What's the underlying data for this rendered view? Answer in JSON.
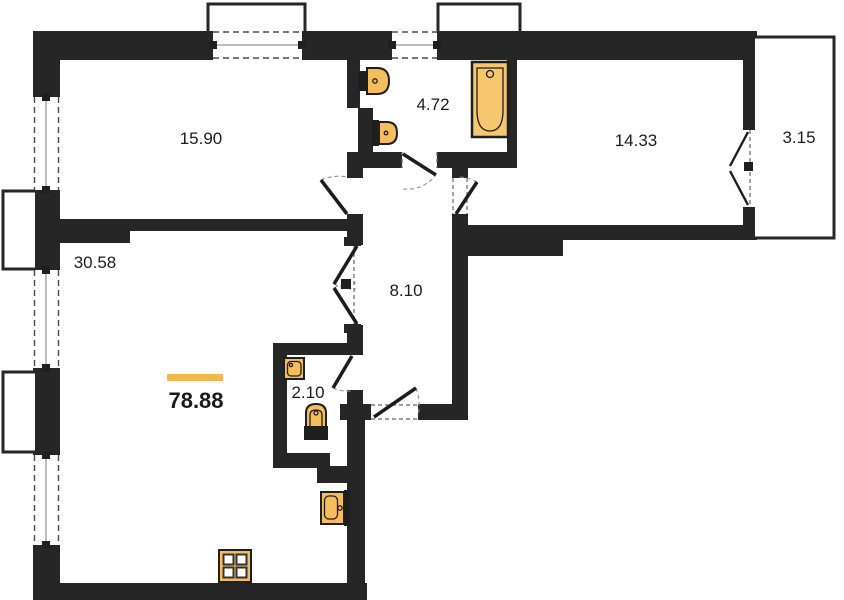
{
  "colors": {
    "wall": "#262626",
    "fixture_fill": "#F5BD5C",
    "bathtub_fill": "#F6C76D",
    "fixture_stroke": "#1f1f1f",
    "accent": "#F2B84A",
    "label_text": "#1d1d1d",
    "background": "#FFFFFF"
  },
  "rooms": [
    {
      "id": "room-top-left",
      "area": "15.90"
    },
    {
      "id": "bathroom",
      "area": "4.72"
    },
    {
      "id": "room-top-right",
      "area": "14.33"
    },
    {
      "id": "balcony",
      "area": "3.15"
    },
    {
      "id": "room-bottom-left",
      "area": "30.58"
    },
    {
      "id": "hallway",
      "area": "8.10"
    },
    {
      "id": "wc",
      "area": "2.10"
    }
  ],
  "total_area": "78.88",
  "fixtures": [
    "bathtub",
    "toilet",
    "sink",
    "washing-machine",
    "wc-toilet",
    "kitchen-sink",
    "stove"
  ]
}
